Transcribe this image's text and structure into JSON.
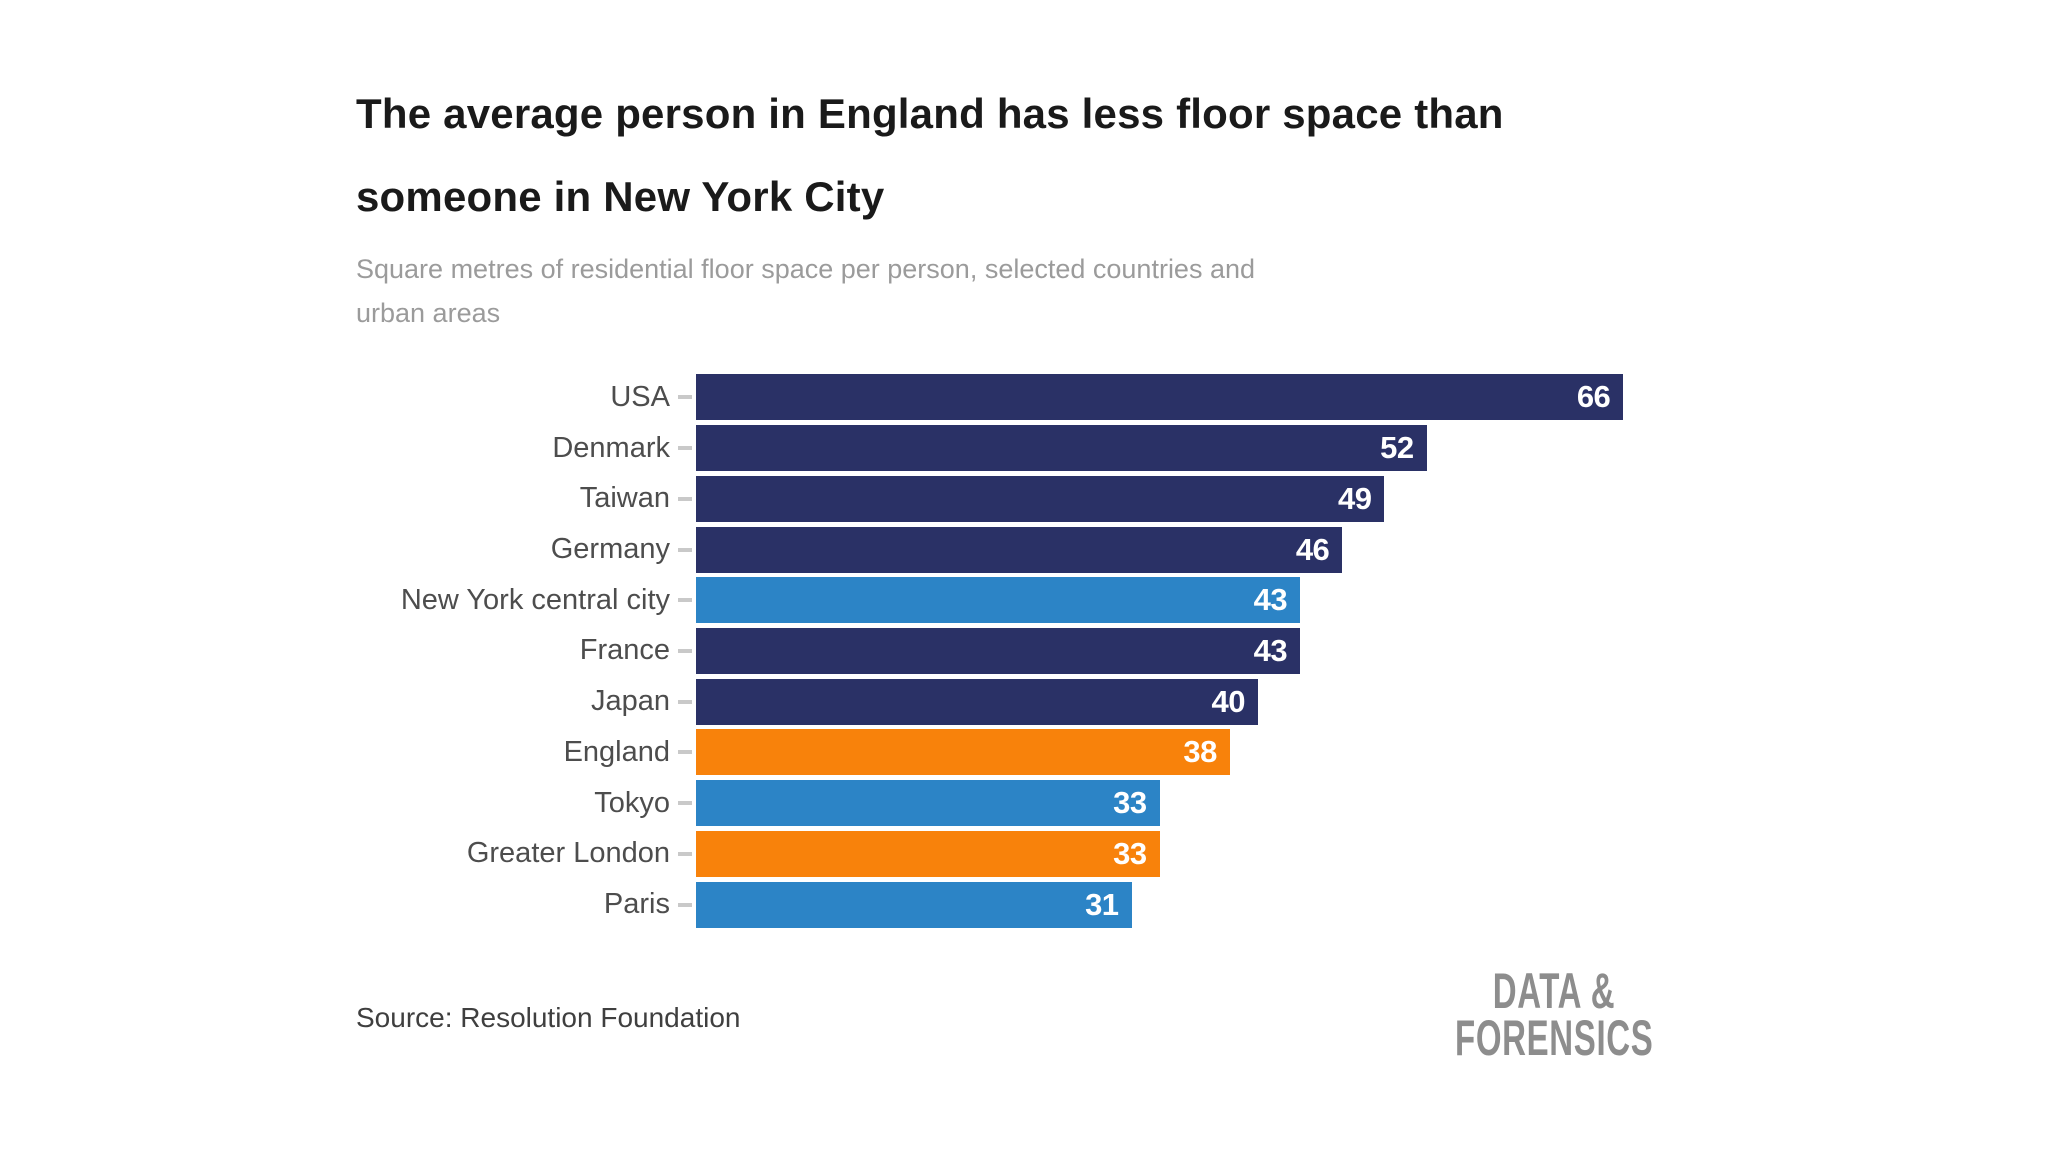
{
  "header": {
    "title_lines": [
      "The average person in England has less floor space than",
      "someone in New York City"
    ],
    "subtitle_lines": [
      "Square metres of residential floor space per person, selected countries and",
      "urban areas"
    ]
  },
  "chart_data": {
    "type": "bar",
    "orientation": "horizontal",
    "title": "The average person in England has less floor space than someone in New York City",
    "subtitle": "Square metres of residential floor space per person, selected countries and urban areas",
    "categories": [
      "USA",
      "Denmark",
      "Taiwan",
      "Germany",
      "New York central city",
      "France",
      "Japan",
      "England",
      "Tokyo",
      "Greater London",
      "Paris"
    ],
    "values": [
      66,
      52,
      49,
      46,
      43,
      43,
      40,
      38,
      33,
      33,
      31
    ],
    "bar_colors": [
      "navy",
      "navy",
      "navy",
      "navy",
      "city_blue",
      "navy",
      "navy",
      "orange",
      "city_blue",
      "orange",
      "city_blue"
    ],
    "palette": {
      "navy": "#2a3166",
      "city_blue": "#2c84c6",
      "orange": "#f8820b"
    },
    "xlim": [
      0,
      66
    ],
    "xlabel": "",
    "ylabel": "",
    "grid": false,
    "legend": null,
    "data_labels": "inside-end",
    "label_color": "#4d4d4d",
    "value_label_color": "#ffffff"
  },
  "footer": {
    "source": "Source: Resolution Foundation",
    "logo_lines": [
      "DATA &",
      "FORENSICS"
    ]
  }
}
